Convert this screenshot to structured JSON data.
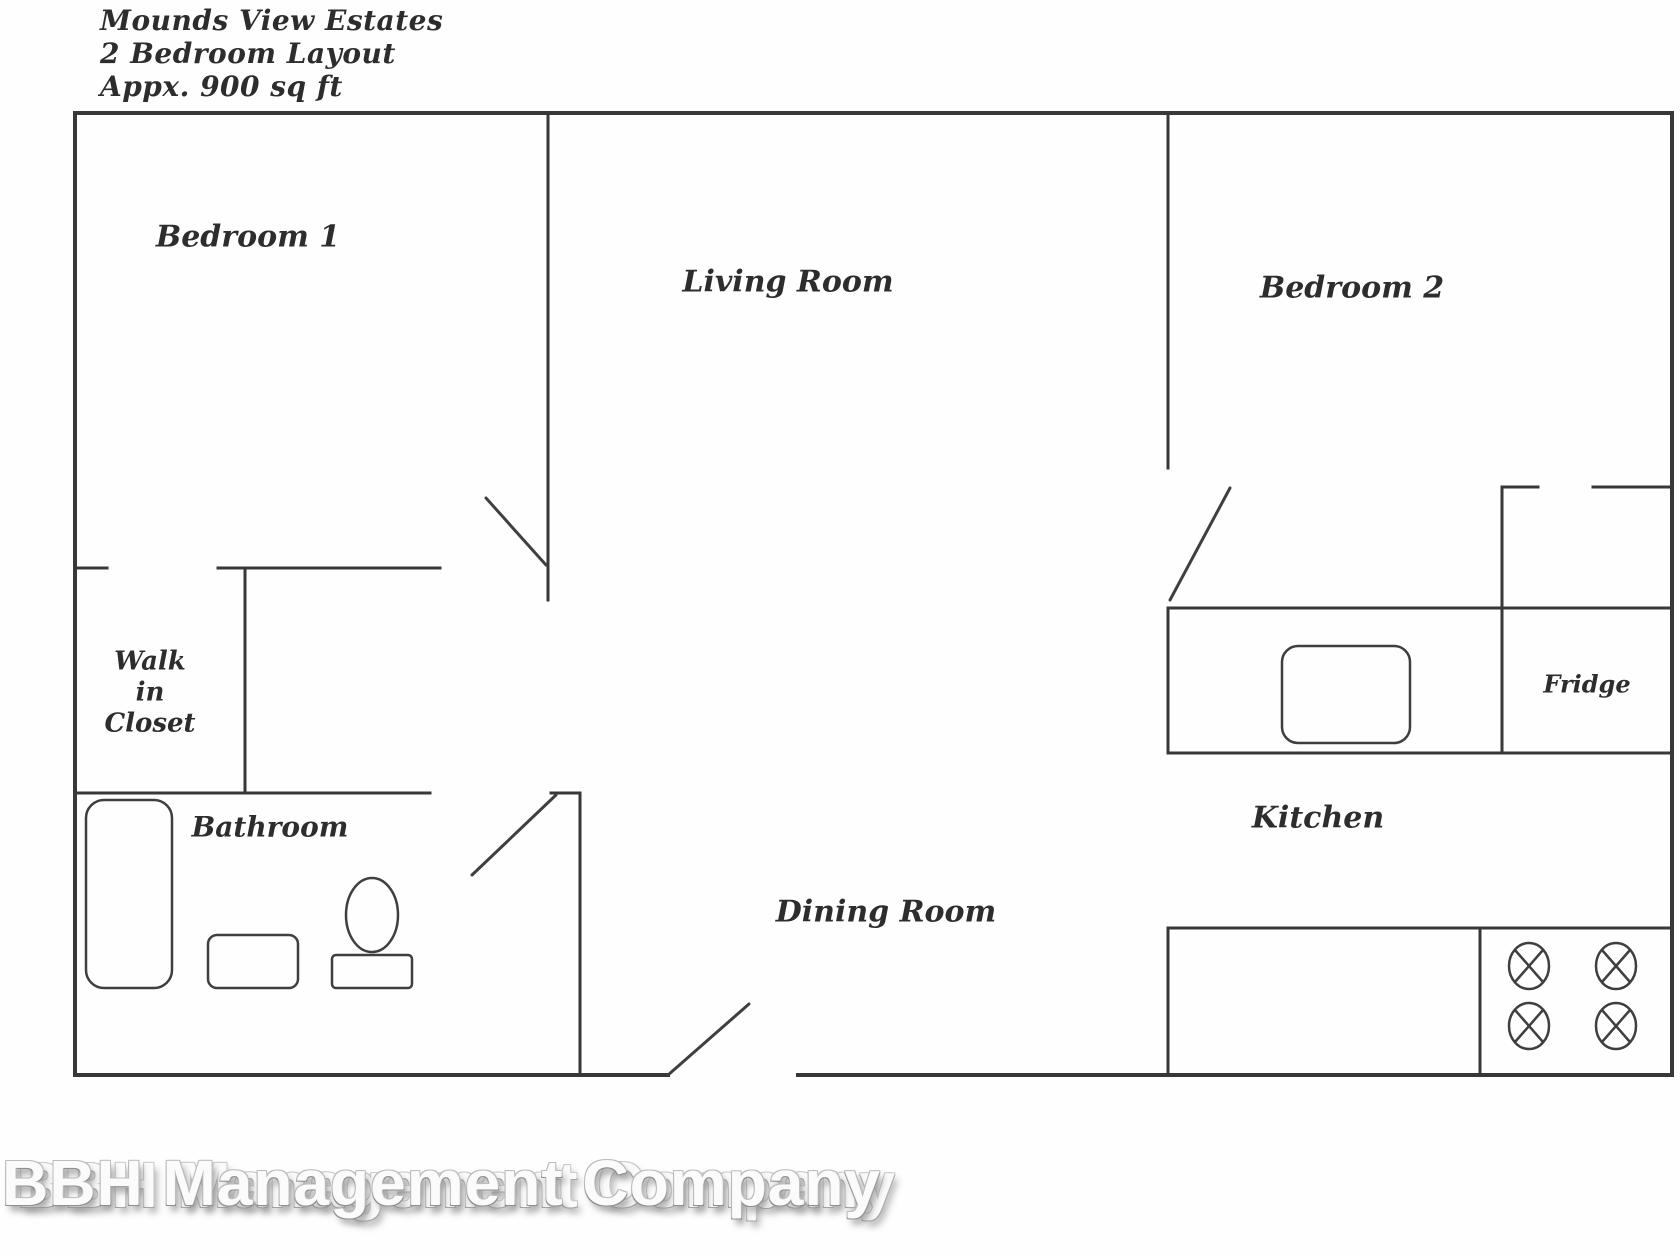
{
  "title": {
    "line1": "Mounds View Estates",
    "line2": "2 Bedroom Layout",
    "line3": "Appx. 900 sq ft"
  },
  "rooms": {
    "bedroom_1": "Bedroom 1",
    "living_room": "Living Room",
    "bedroom_2": "Bedroom 2",
    "walk_in_closet_line1": "Walk",
    "walk_in_closet_line2": "in",
    "walk_in_closet_line3": "Closet",
    "bathroom": "Bathroom",
    "dining_room": "Dining Room",
    "kitchen": "Kitchen",
    "fridge": "Fridge"
  },
  "watermark": "BBH Management Company",
  "colors": {
    "wall": "#383838",
    "door": "#3f3f3f",
    "fixture": "#3f3f3f",
    "label": "#2d2d2d",
    "background": "#fefefe"
  }
}
